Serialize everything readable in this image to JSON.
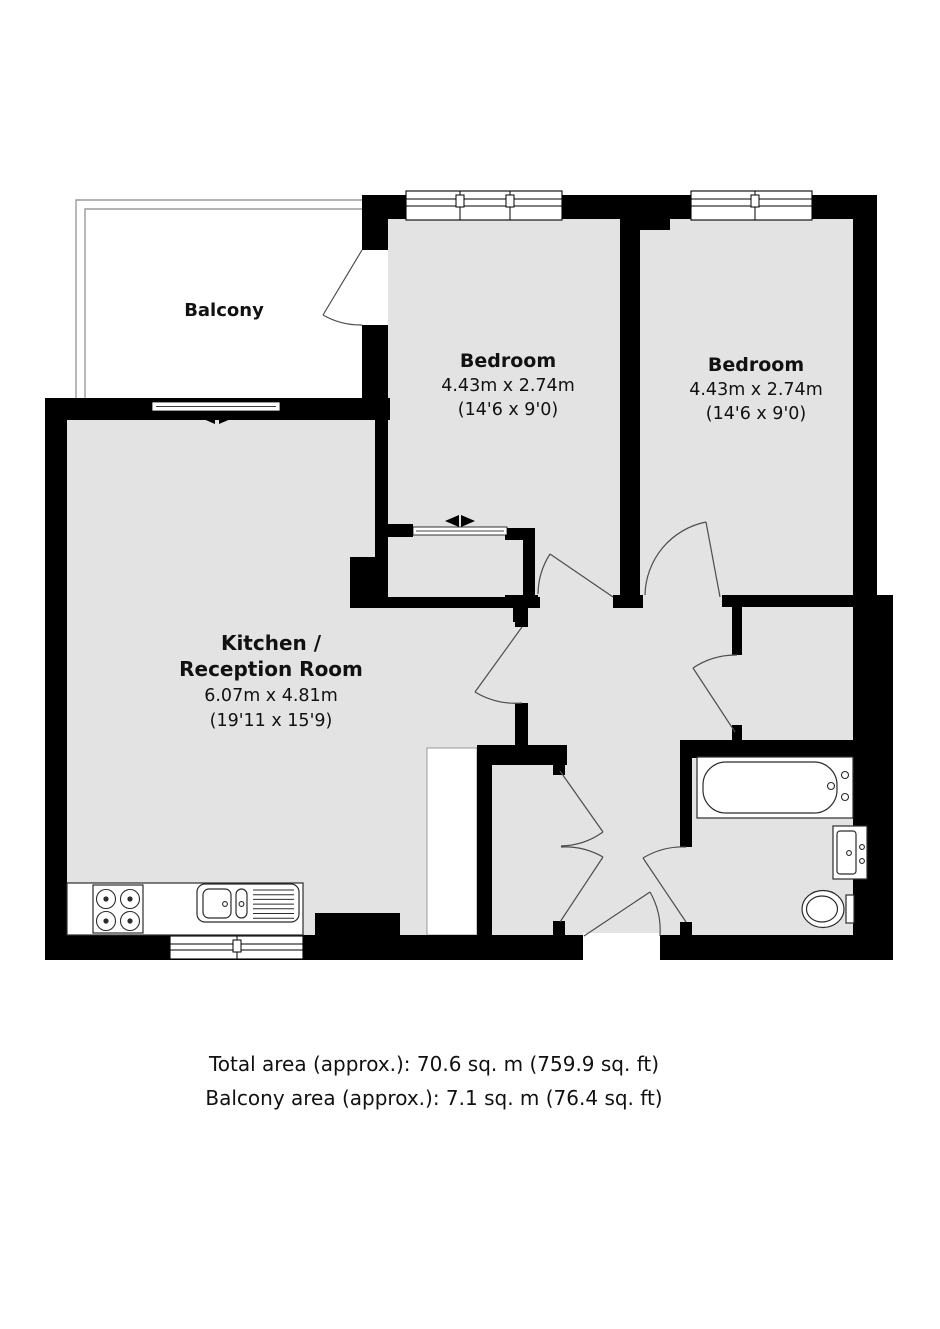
{
  "floorplan": {
    "rooms": {
      "balcony": {
        "name": "Balcony"
      },
      "bedroom1": {
        "name": "Bedroom",
        "metric": "4.43m x 2.74m",
        "imperial": "(14'6 x 9'0)"
      },
      "bedroom2": {
        "name": "Bedroom",
        "metric": "4.43m x 2.74m",
        "imperial": "(14'6 x 9'0)"
      },
      "kitchen_reception": {
        "name_line1": "Kitchen /",
        "name_line2": "Reception Room",
        "metric": "6.07m x 4.81m",
        "imperial": "(19'11 x 15'9)"
      }
    },
    "fixtures": [
      "hob-4-burners",
      "kitchen-sink-with-drainer",
      "kitchen-counter",
      "bathtub",
      "wash-basin",
      "toilet",
      "built-in-wardrobe",
      "double-door-closet"
    ],
    "markers": {
      "sliding_door": "left-right-arrow-marker"
    },
    "colors": {
      "wall": "#000000",
      "floor": "#e3e3e3",
      "background": "#ffffff",
      "door_arc": "#4d4d4d",
      "railing": "#9a9a9a"
    }
  },
  "footer": {
    "total_area": "Total area (approx.): 70.6 sq. m (759.9 sq. ft)",
    "balcony_area": "Balcony area (approx.): 7.1 sq. m (76.4 sq. ft)"
  }
}
